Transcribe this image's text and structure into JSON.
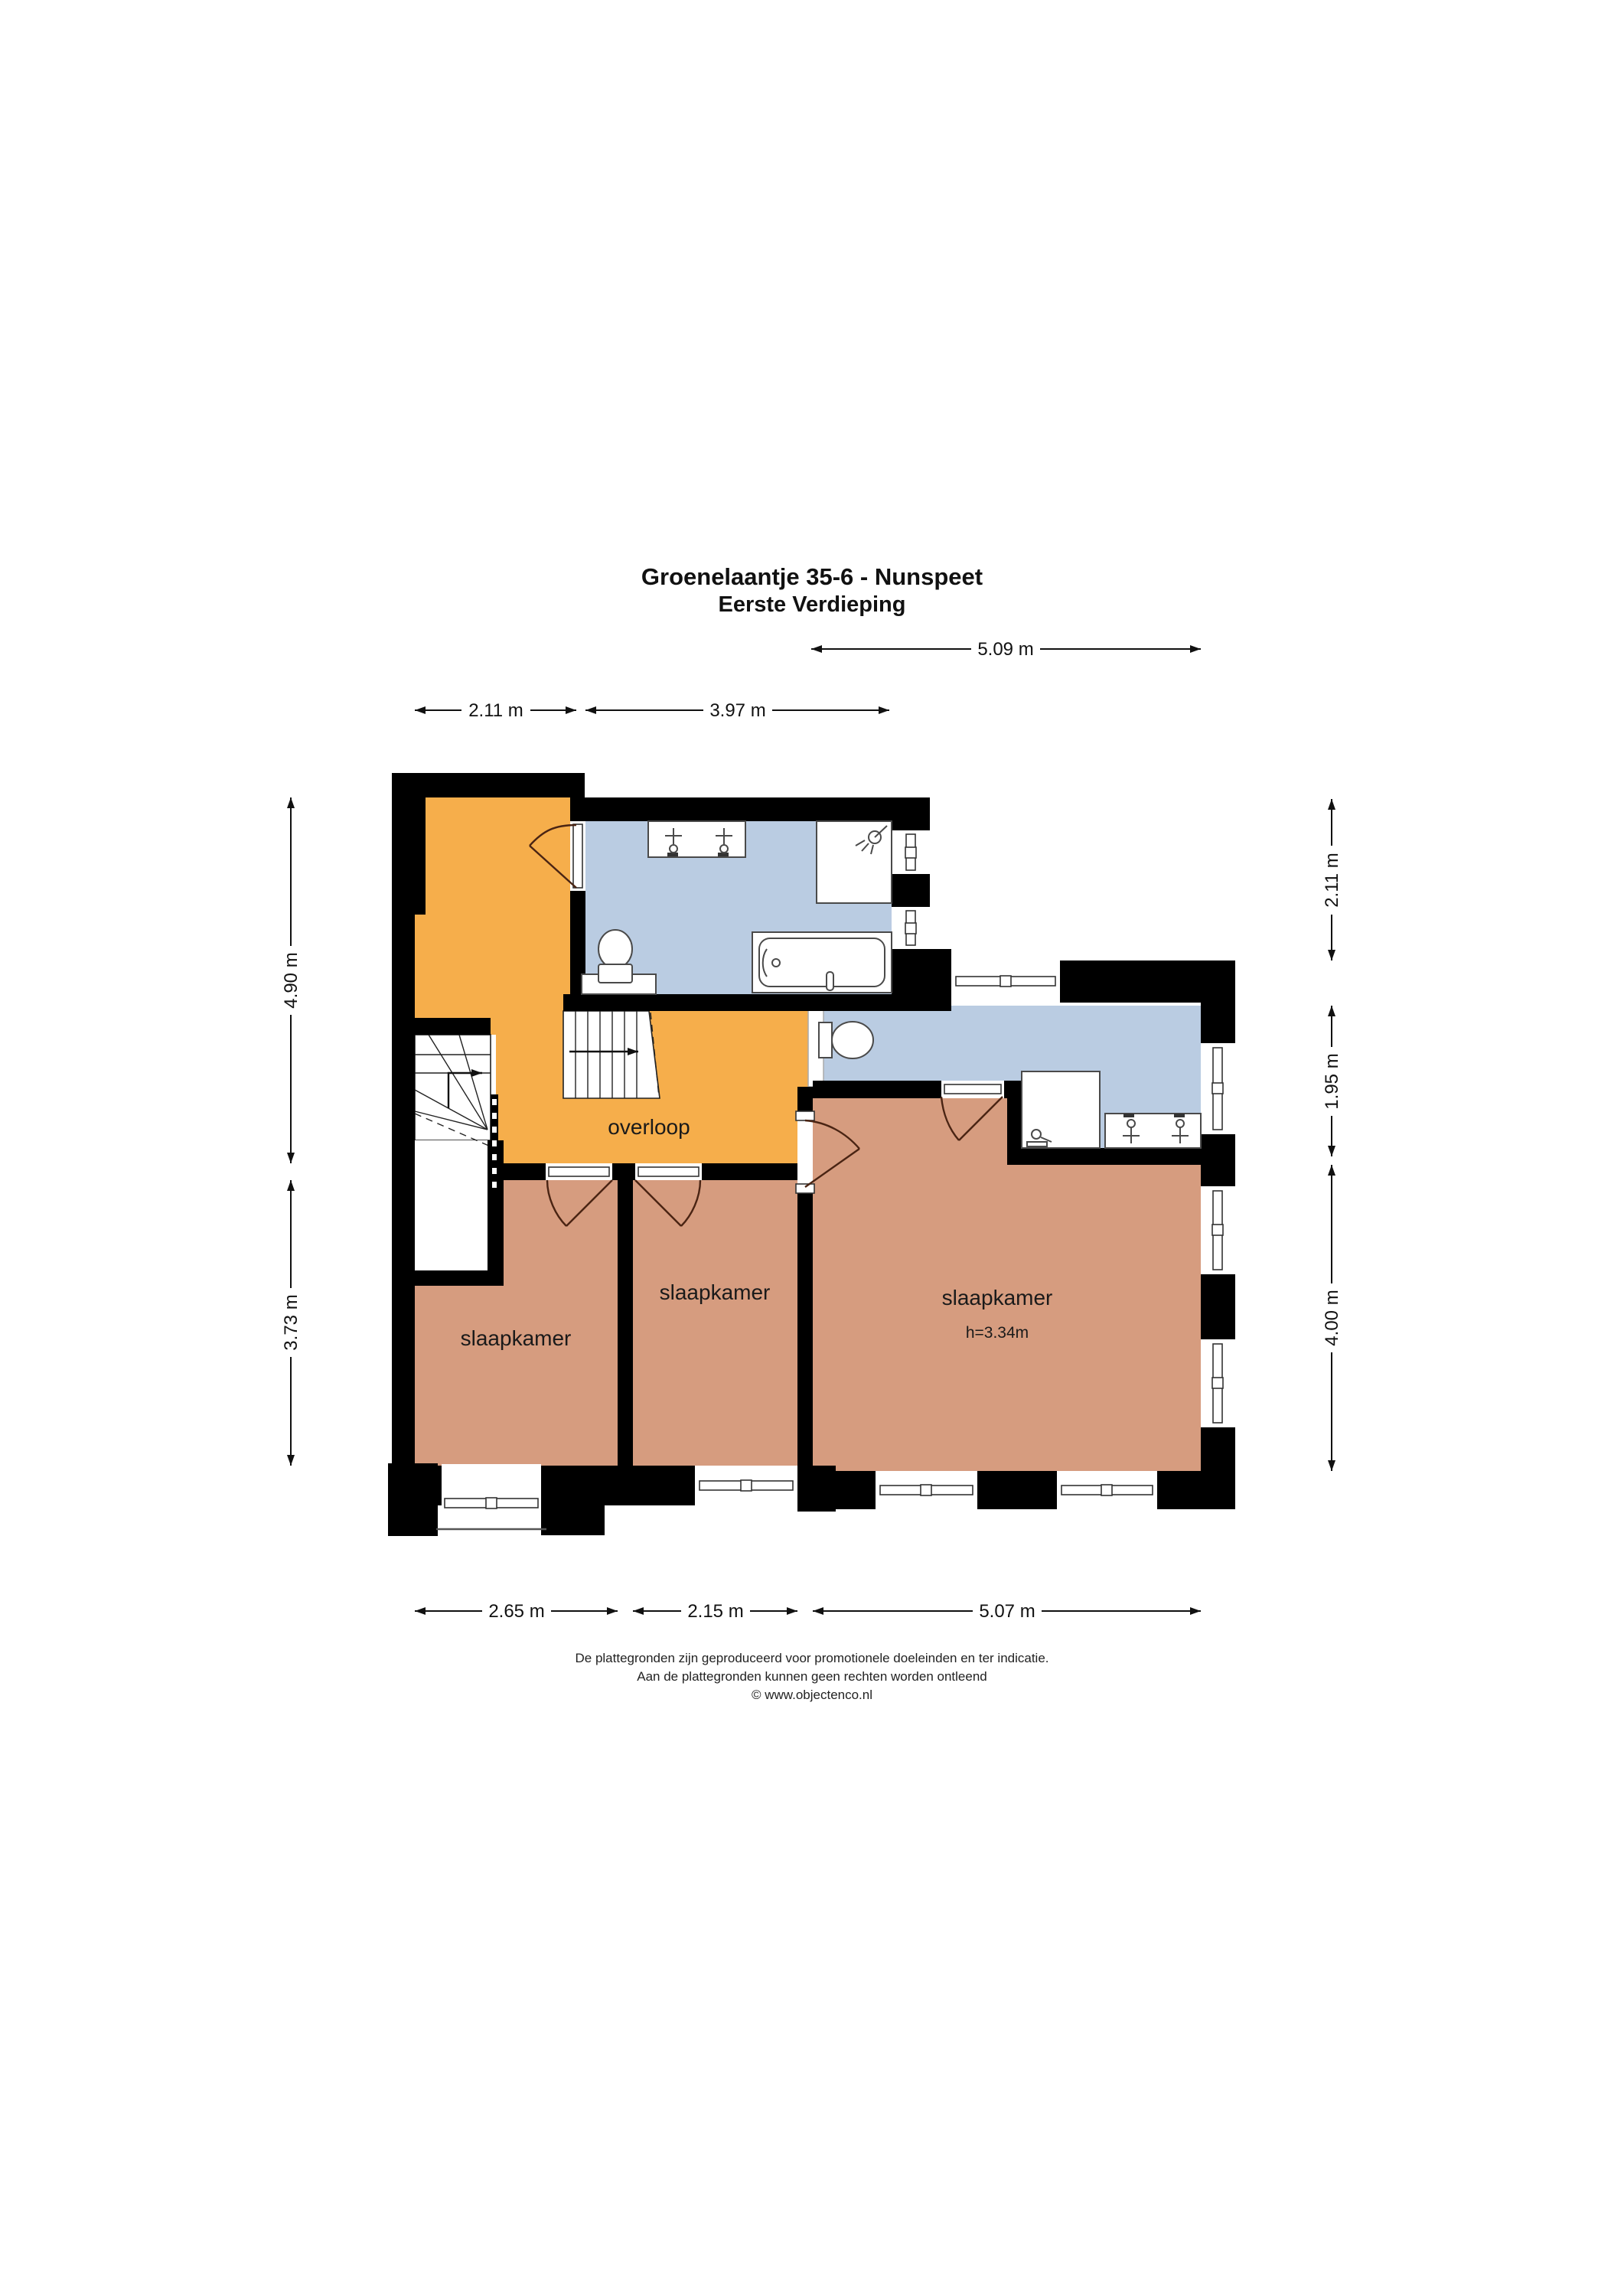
{
  "title": {
    "line1": "Groenelaantje 35-6 - Nunspeet",
    "line2": "Eerste Verdieping"
  },
  "rooms": {
    "overloop": "overloop",
    "bedroom1": "slaapkamer",
    "bedroom2": "slaapkamer",
    "bedroom3": "slaapkamer",
    "bedroom3_height": "h=3.34m"
  },
  "dims": {
    "top_a": "5.09 m",
    "top_b": "2.11 m",
    "top_c": "3.97 m",
    "left_a": "4.90 m",
    "left_b": "3.73 m",
    "right_a": "2.11 m",
    "right_b": "1.95 m",
    "right_c": "4.00 m",
    "bottom_a": "2.65 m",
    "bottom_b": "2.15 m",
    "bottom_c": "5.07 m"
  },
  "footer": {
    "line1": "De plattegronden zijn geproduceerd voor promotionele doeleinden en ter indicatie.",
    "line2": "Aan de plattegronden kunnen geen rechten worden ontleend",
    "line3": "© www.objectenco.nl"
  },
  "colors": {
    "wall": "#000000",
    "room_hall": "#F6AE4B",
    "room_bedroom": "#D69C7F",
    "room_bath": "#BACCE2",
    "paper": "#FFFFFF"
  }
}
